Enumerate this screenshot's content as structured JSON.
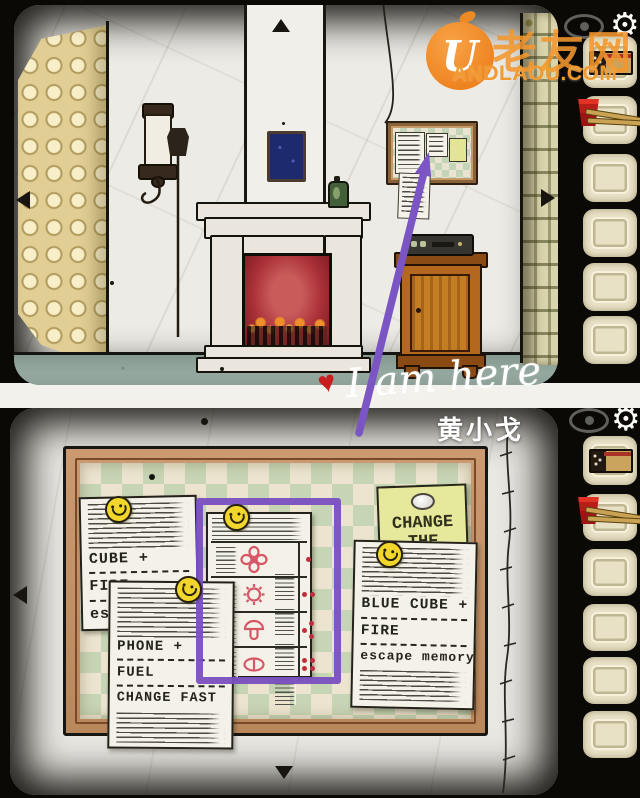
{
  "watermark": {
    "logo_letter": "U",
    "cjk": "老友网",
    "site": "ANDLAOU.COM",
    "accent_color": "#f09a30"
  },
  "hud": {
    "gear_icon": "⚙",
    "eye_icon": "eye"
  },
  "annotation": {
    "heart": "♥",
    "message": "I am here",
    "signature": "黄小戈",
    "arrow_color": "#7a4fc0"
  },
  "inventory_top": {
    "slot1_item": "matchbox",
    "slot2_item": "red cup with chopsticks",
    "empty_slots": 4
  },
  "inventory_bottom": {
    "slot1_item": "matchbox",
    "slot2_item": "red cup with chopsticks",
    "empty_slots": 4
  },
  "board": {
    "sticky_note": {
      "line1": "CHANGE",
      "line2": "THE"
    },
    "left_paper": {
      "title": "CUBE +",
      "line2": "FIRE",
      "line3": "esc"
    },
    "front_paper": {
      "title": "PHONE +",
      "line2": "FUEL",
      "line3": "CHANGE FAST"
    },
    "right_paper": {
      "title": "BLUE CUBE +",
      "line2": "FIRE",
      "line3": "escape memory"
    },
    "symbol_paper": {
      "rows": [
        {
          "symbol": "four-petal-flower",
          "dots": 1
        },
        {
          "symbol": "sun",
          "dots": 2
        },
        {
          "symbol": "mushroom",
          "dots": 3
        },
        {
          "symbol": "split-pill",
          "dots": 4
        }
      ],
      "symbol_color": "#d65868",
      "dot_color": "#bf2e3c"
    }
  }
}
